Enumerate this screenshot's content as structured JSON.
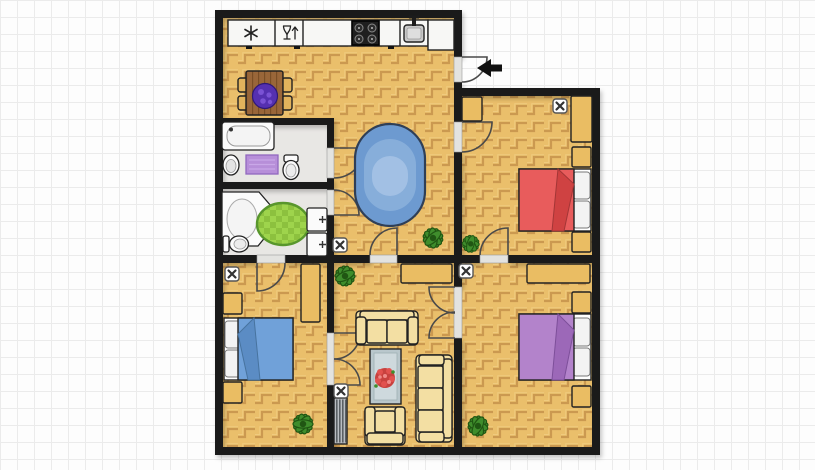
{
  "canvas": {
    "type": "floorplan",
    "grid_px": 17,
    "width": 815,
    "height": 470
  },
  "palette": {
    "bg": "#fdfdfd",
    "grid": "#ebebeb",
    "wall": "#1a1a1a",
    "wood": "#eabf6b",
    "woodline": "#c6934b",
    "woodlight": "#f3d38c",
    "bathfloor": "#e8e7e4",
    "sill": "#e3e3e0",
    "door": "#4a4a4a",
    "counter": "#f7f7f5",
    "stove": "#1f1f1f",
    "basin": "#c9c9c9",
    "tablewood": "#996639",
    "plankline": "#7a4e26",
    "chair": "#e2b35c",
    "white": "#fbfbfb",
    "matpurple": "#b78fd9",
    "ruggreen1": "#9ed44c",
    "ruggreen2": "#8cc13e",
    "rugband": "#58962c",
    "hallrug1": "#6d9ad0",
    "hallrug2": "#87aeda",
    "hallrug3": "#a2c0e4",
    "hallrugedge": "#2f3f57",
    "bedred": "#e85c5c",
    "bedredfold": "#cf4242",
    "bedblue": "#70a1d9",
    "bedbluefold": "#5b8cc4",
    "bedpurple": "#b383cb",
    "bedpurplefold": "#9c68b8",
    "pillow": "#f3f3f3",
    "tan": "#eabd63",
    "cream": "#f3dfa3",
    "glass1": "#b9c7cc",
    "glass2": "#ced9dd",
    "flower": "#e2514e",
    "plant": "#3f8d2c",
    "plantdark": "#205613",
    "centerpiece": "#5530b0",
    "radiator": "#b9bdc1",
    "radiatorbar": "#5b6064",
    "marker": "#ffffff",
    "markerx": "#333333",
    "arrow": "#111111"
  },
  "icons": [
    "snowflake-icon",
    "wine-glass-icon",
    "cooktop-burners-icon",
    "sink-tap-icon",
    "entry-arrow-icon",
    "ceiling-lamp-icon"
  ],
  "rooms": [
    {
      "name": "kitchen-dining",
      "floor": "parquet",
      "objects": [
        "refrigerator",
        "glass-cabinet",
        "countertop",
        "cooktop",
        "kitchen-sink",
        "dining-table",
        "chair x4",
        "purple-plant-centerpiece"
      ]
    },
    {
      "name": "hallway",
      "floor": "parquet",
      "objects": [
        "blue-oval-rug",
        "potted-plant",
        "ceiling-lamp"
      ]
    },
    {
      "name": "bathroom-top",
      "floor": "tile",
      "objects": [
        "bathtub",
        "purple-bath-mat",
        "wash-basin",
        "toilet",
        "door"
      ]
    },
    {
      "name": "bathroom-bottom",
      "floor": "tile",
      "objects": [
        "corner-bathtub",
        "round-green-rug",
        "toilet",
        "wash-basin x2",
        "door"
      ]
    },
    {
      "name": "bedroom-red",
      "floor": "parquet",
      "objects": [
        "double-bed-red",
        "nightstand x2",
        "wardrobe x2",
        "ceiling-lamp",
        "potted-plant",
        "door x2"
      ]
    },
    {
      "name": "bedroom-blue",
      "floor": "parquet",
      "objects": [
        "double-bed-blue",
        "nightstand x2",
        "wardrobe",
        "ceiling-lamp",
        "potted-plant",
        "door",
        "double-door"
      ]
    },
    {
      "name": "bedroom-purple",
      "floor": "parquet",
      "objects": [
        "double-bed-purple",
        "nightstand x2",
        "wardrobe",
        "ceiling-lamp",
        "potted-plant",
        "double-door"
      ]
    },
    {
      "name": "living-room",
      "floor": "parquet",
      "objects": [
        "sideboard",
        "loveseat",
        "sofa-3seat",
        "armchair",
        "coffee-table-with-flowers",
        "radiator",
        "ceiling-lamp",
        "potted-plant",
        "door"
      ]
    },
    {
      "name": "entry",
      "objects": [
        "entry-door",
        "direction-arrow"
      ]
    }
  ]
}
